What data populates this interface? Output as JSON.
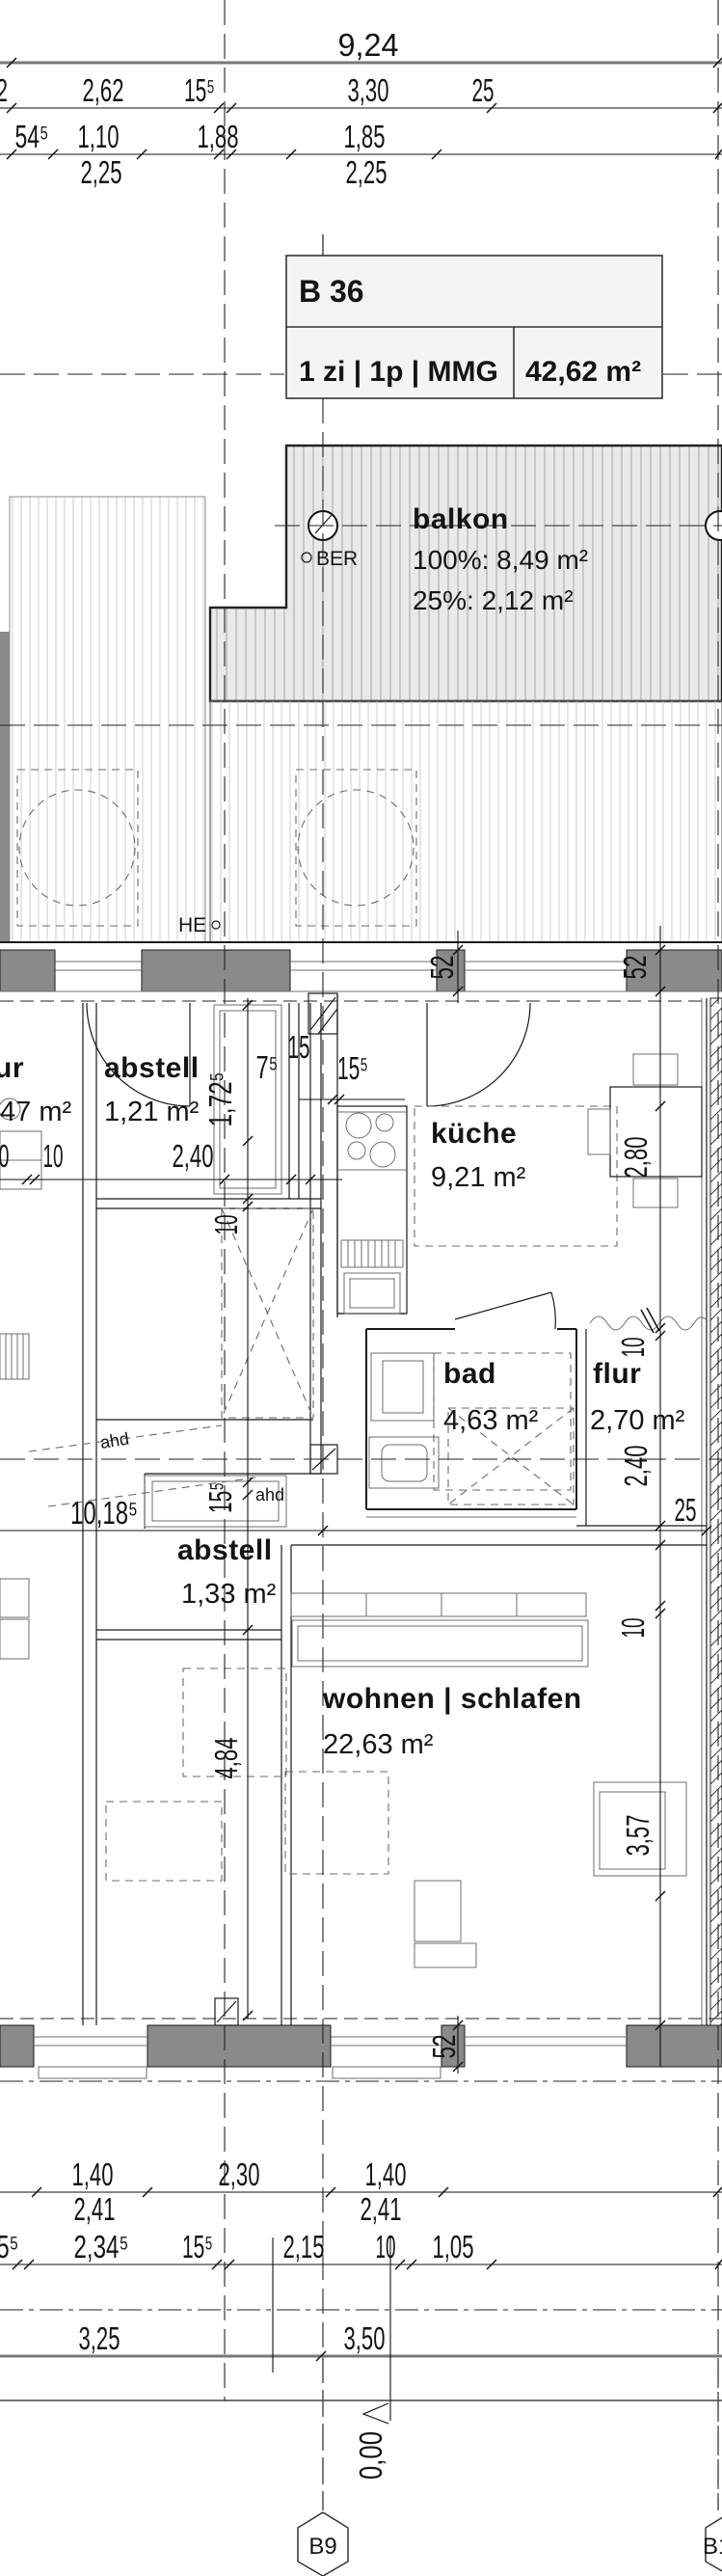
{
  "title_box": {
    "unit": "B 36",
    "type": "1 zi | 1p | MMG",
    "area": "42,62 m²"
  },
  "balcony": {
    "name": "balkon",
    "area_100": "100%: 8,49 m²",
    "area_25": "25%: 2,12 m²",
    "ber": "BER",
    "he": "HE"
  },
  "rooms": {
    "abstell1": {
      "name": "abstell",
      "area": "1,21 m²"
    },
    "kueche": {
      "name": "küche",
      "area": "9,21 m²"
    },
    "bad": {
      "name": "bad",
      "area": "4,63 m²"
    },
    "flur": {
      "name": "flur",
      "area": "2,70 m²"
    },
    "abstell2": {
      "name": "abstell",
      "area": "1,33 m²"
    },
    "wohnen": {
      "name": "wohnen | schlafen",
      "area": "22,63 m²"
    },
    "left_partial": {
      "name": "ur",
      "area": "47 m²"
    }
  },
  "annotations": {
    "ahd1": "ahd",
    "ahd2": "ahd"
  },
  "markers": {
    "grid_bottom": "B9",
    "grid_bottom_right": "B1",
    "level": "0,00"
  },
  "dims": {
    "top_total": "9,24",
    "top_row2": [
      "2",
      "2,62",
      "15⁵",
      "3,30",
      "25"
    ],
    "top_row3": [
      "54⁵",
      "1,10",
      "1,88",
      "1,85"
    ],
    "top_sills": [
      "2,25",
      "2,25"
    ],
    "wall_52_left": "52",
    "wall_52_right": "52",
    "wall_52_bottom": "52",
    "kitchen_offset": "10",
    "kitchen_width": "2,40",
    "left_cut": "0",
    "w75": "7⁵",
    "w15": "15",
    "w155": "15⁵",
    "shaft_h": "1,72⁵",
    "v10a": "10",
    "v155": "15⁵",
    "v484": "4,84",
    "total_width": "10,18⁵",
    "v280": "2,80",
    "v10b": "10",
    "v240": "2,40",
    "h25": "25",
    "v10c": "10",
    "v357": "3,57",
    "bot_rowA": [
      "1,40",
      "2,30",
      "1,40"
    ],
    "bot_rowA2": [
      "2,41",
      "2,41"
    ],
    "bot_rowC": [
      "5⁵",
      "2,34⁵",
      "15⁵",
      "2,15",
      "10",
      "1,05"
    ],
    "bot_rowD": [
      "3,25",
      "3,50"
    ]
  }
}
